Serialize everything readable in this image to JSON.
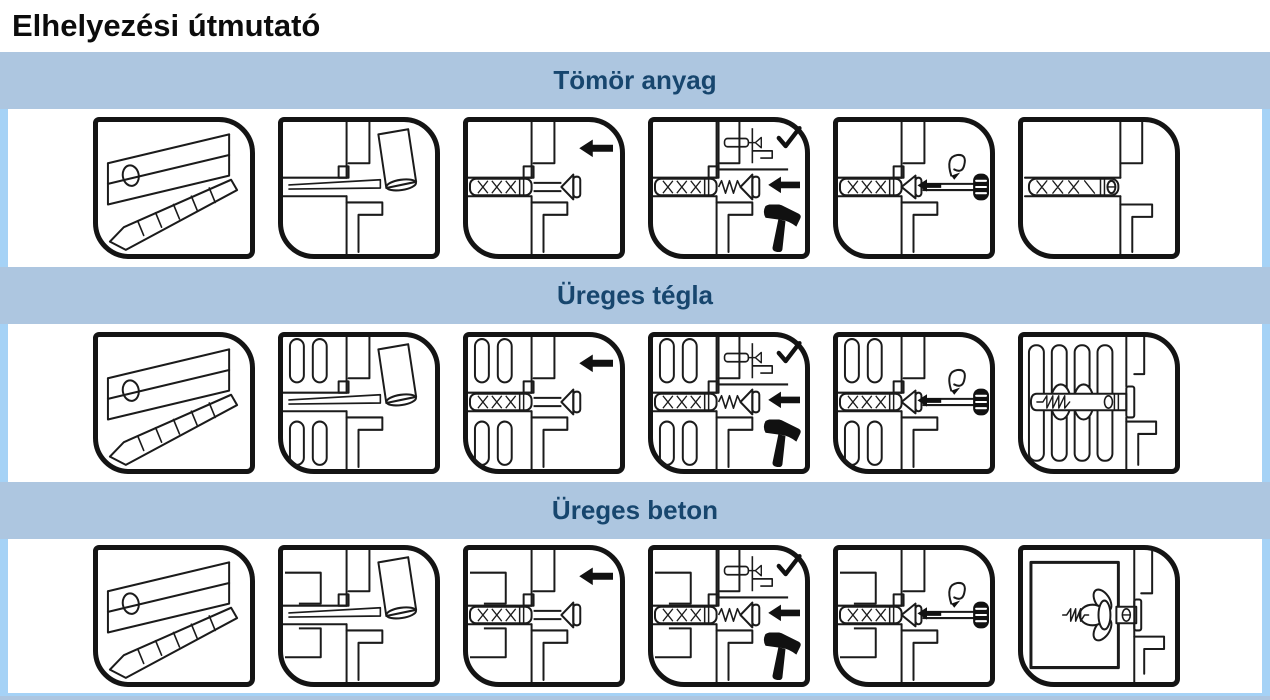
{
  "page": {
    "title": "Elhelyezési útmutató"
  },
  "table": {
    "sections": [
      {
        "label": "Tömör anyag",
        "material": "solid-material",
        "steps": [
          "fixture-and-drill-bit",
          "drill-hole-in-wall",
          "insert-anchor",
          "hammer-in-screw",
          "tighten-with-screwdriver",
          "anchor-installed"
        ]
      },
      {
        "label": "Üreges tégla",
        "material": "hollow-brick",
        "steps": [
          "fixture-and-drill-bit",
          "drill-hole-in-wall",
          "insert-anchor",
          "hammer-in-screw",
          "tighten-with-screwdriver",
          "anchor-installed"
        ]
      },
      {
        "label": "Üreges beton",
        "material": "hollow-concrete",
        "steps": [
          "fixture-and-drill-bit",
          "drill-hole-in-wall",
          "insert-anchor",
          "hammer-in-screw",
          "tighten-with-screwdriver",
          "anchor-installed"
        ]
      }
    ]
  },
  "icons": {
    "arrow-left": "solid black left-pointing arrow",
    "check": "black checkmark",
    "hammer": "black hammer silhouette",
    "screwdriver": "screwdriver with black handle",
    "rotation": "spiral turning arrow",
    "drill-bit": "spiral drill bit line art"
  },
  "colors": {
    "band_background": "#adc6e0",
    "band_text": "#17466e",
    "outer_border": "#a5d2f6",
    "panel_frame": "#141414",
    "line_art": "#1b1b1b",
    "page_background": "#ffffff"
  }
}
